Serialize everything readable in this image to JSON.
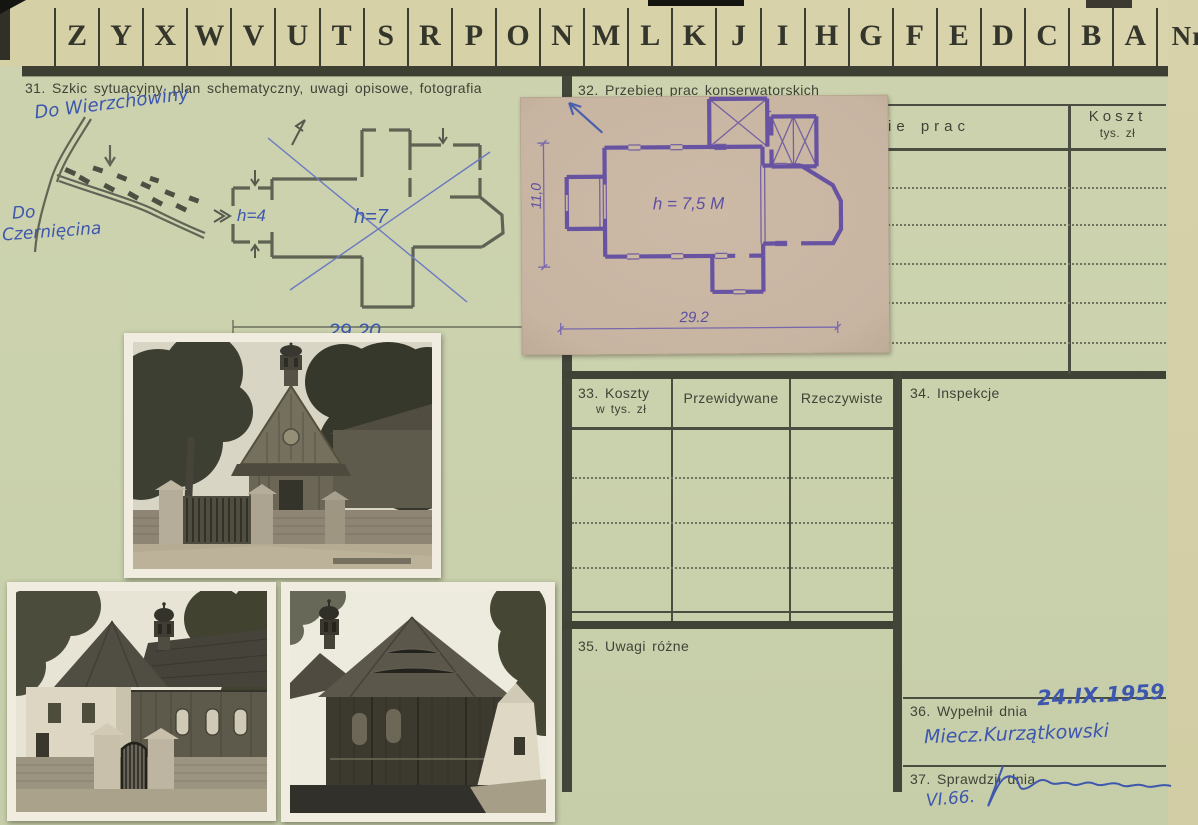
{
  "card_header": {
    "alphabet": [
      "Z",
      "Y",
      "X",
      "W",
      "V",
      "U",
      "T",
      "S",
      "R",
      "P",
      "O",
      "N",
      "M",
      "L",
      "K",
      "J",
      "I",
      "H",
      "G",
      "F",
      "E",
      "D",
      "C",
      "B",
      "A"
    ],
    "number_label": "Nr"
  },
  "section31": {
    "title": "31. Szkic sytuacyjny, plan schematyczny, uwagi opisowe, fotografia",
    "note_top": "Do Wierzchowiny",
    "note_left_line1": "Do",
    "note_left_line2": "Czernięcina",
    "plan_height_porch": "h=4",
    "plan_height_nave": "h=7",
    "plan_length": "29,20"
  },
  "section32": {
    "title": "32. Przebieg prac konserwatorskich",
    "col_works_visible": "ie prac",
    "col_cost_line1": "Koszt",
    "col_cost_line2": "tys. zł"
  },
  "section33": {
    "title_line1": "33. Koszty",
    "title_line2": "w tys. zł",
    "col_planned": "Przewidywane",
    "col_actual": "Rzeczywiste"
  },
  "section34": {
    "title": "34. Inspekcje"
  },
  "section35": {
    "title": "35. Uwagi różne"
  },
  "section36": {
    "title": "36. Wypełnił dnia",
    "handwritten_date": "24.IX.1959",
    "handwritten_name": "Miecz.Kurzątkowski"
  },
  "section37": {
    "title": "37. Sprawdził dnia",
    "handwritten_date": "VI.66."
  },
  "blueprint": {
    "height_note": "h = 7,5 M",
    "length_dim": "29.2",
    "width_dim": "11,0"
  },
  "colors": {
    "card_green": "#cbd2ae",
    "card_tan": "#d7d1a8",
    "print_ink": "#3f4337",
    "handwriting_blue": "#3d57ae",
    "blueprint_paper": "#c8b5a2",
    "blueprint_ink": "#6b58a6",
    "pencil": "#5a5e50"
  }
}
